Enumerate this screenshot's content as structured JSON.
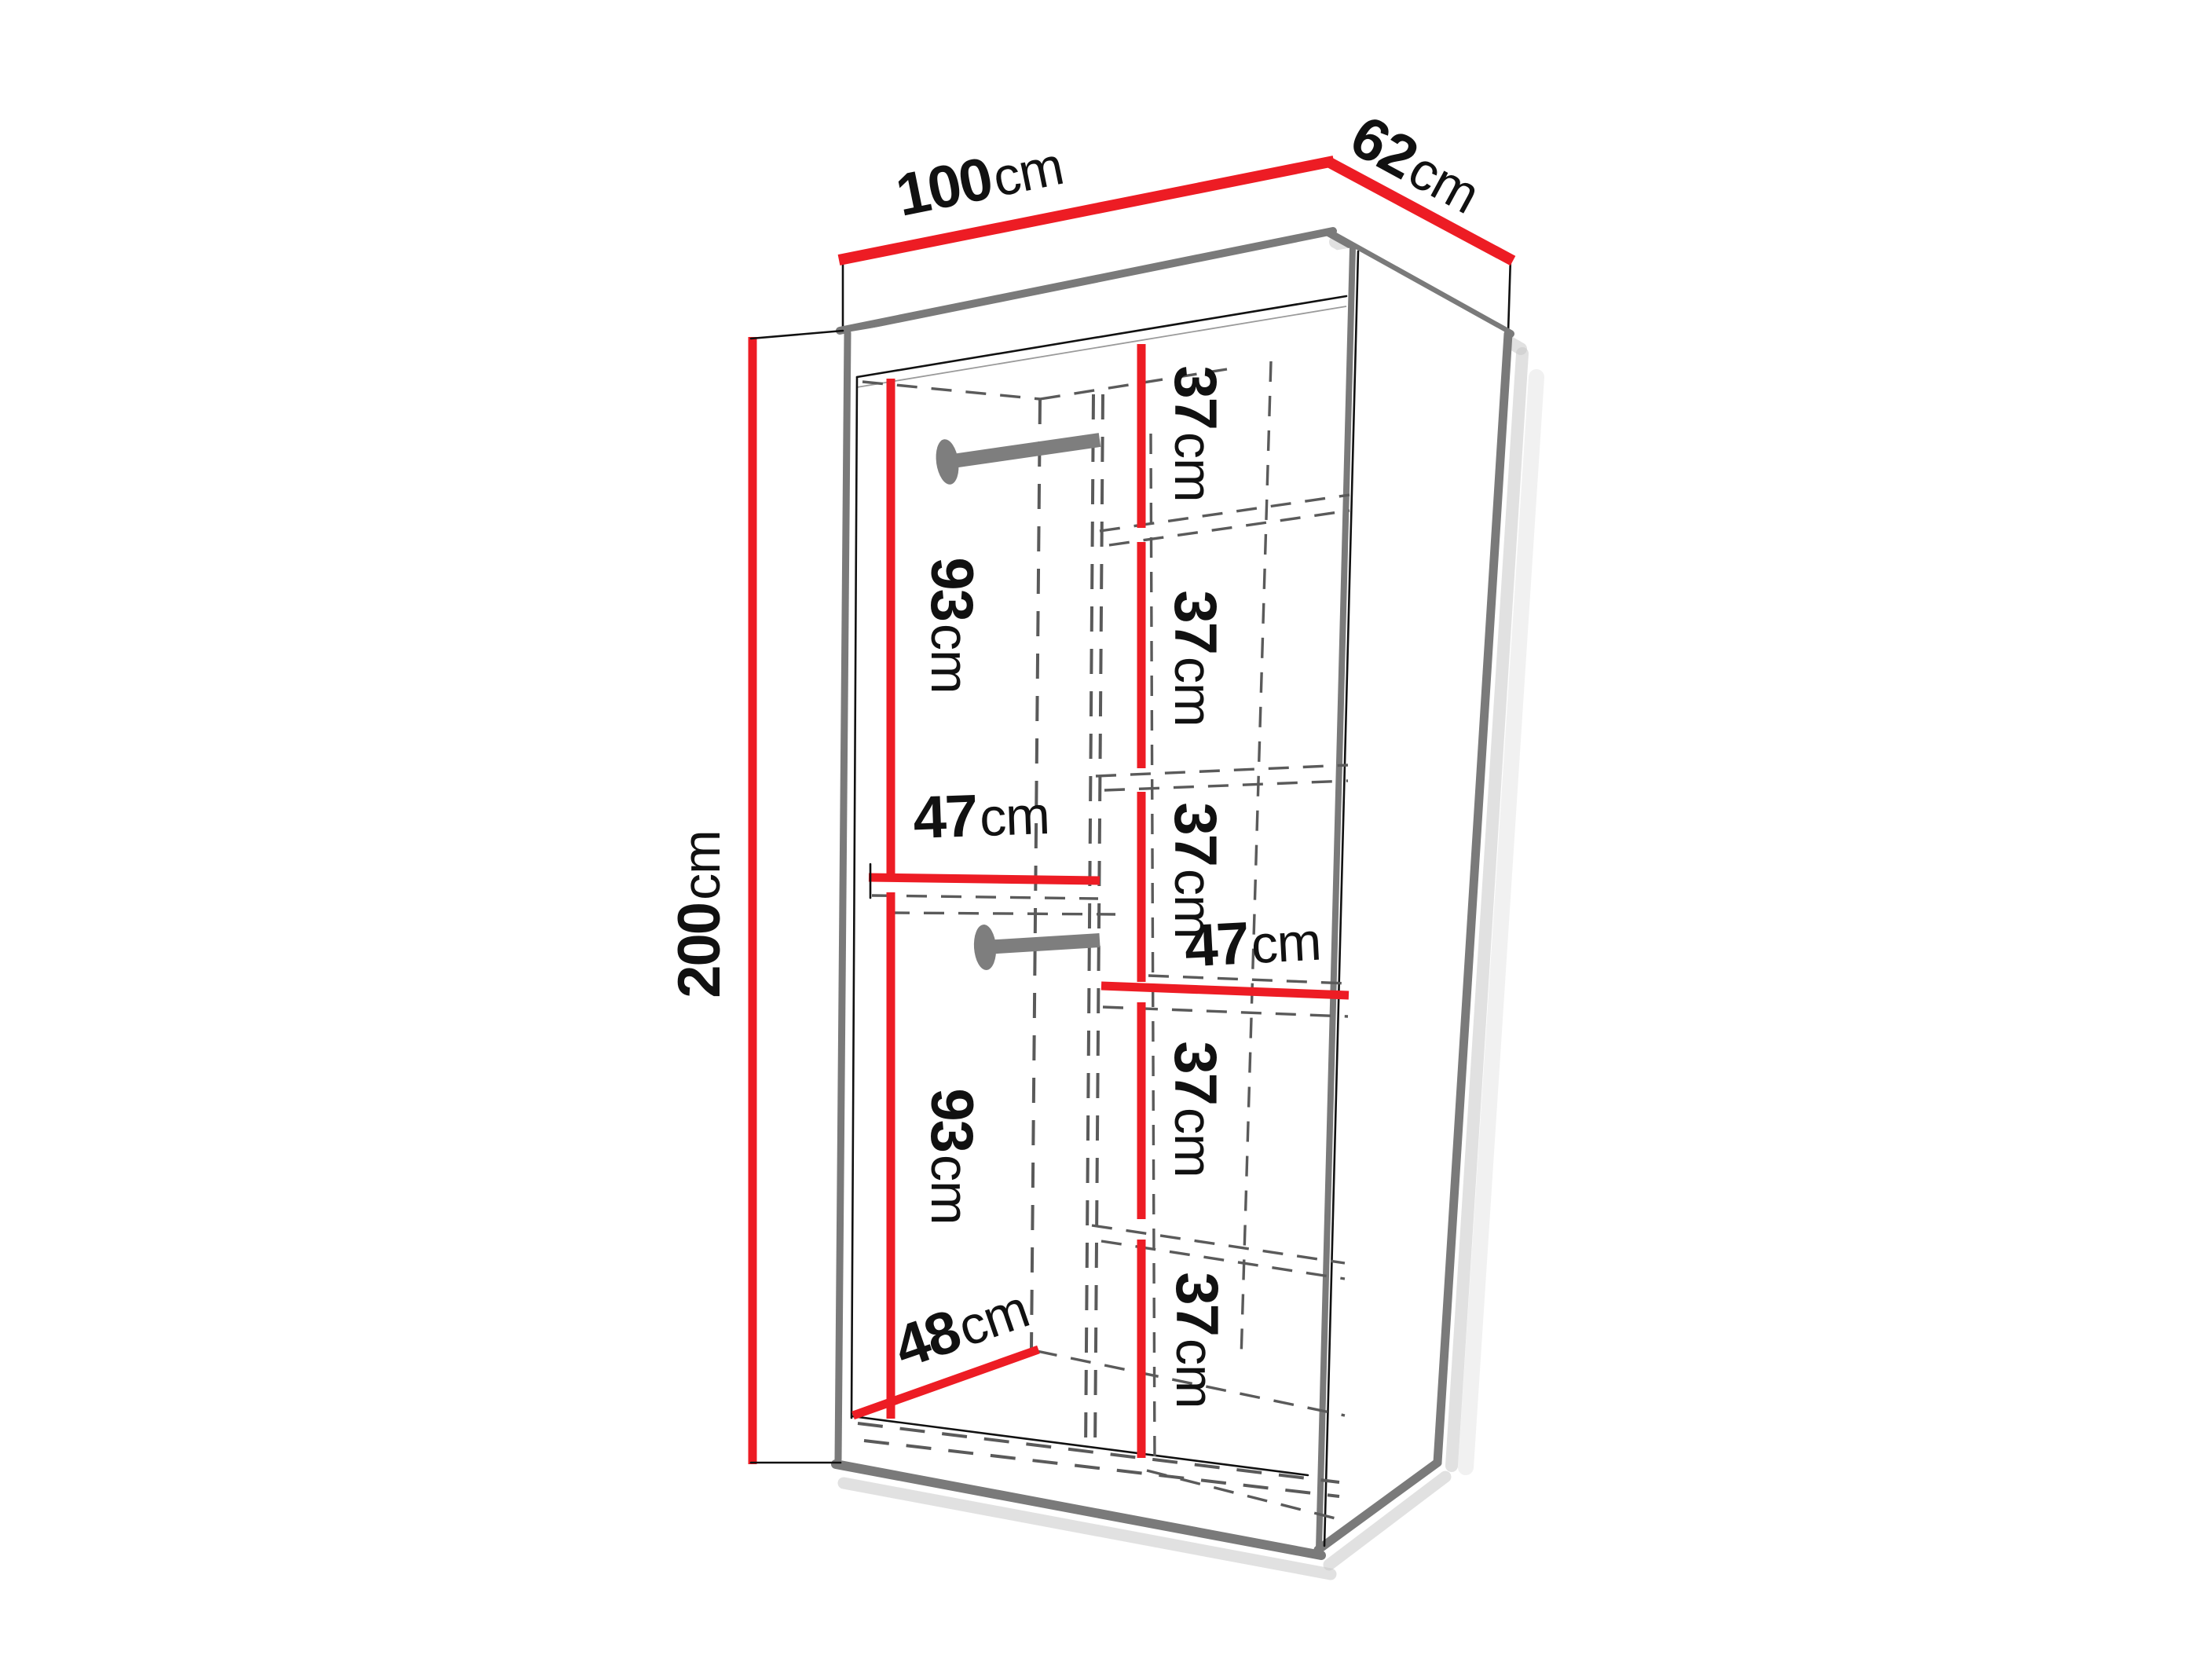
{
  "diagram": {
    "kind": "furniture dimension drawing",
    "subject": "wardrobe with two hanging rods and five shelf compartments",
    "units": "cm"
  },
  "colors": {
    "dimension_red": "#ed1c24",
    "edge_gray": "#7a7a7a",
    "ink_black": "#111111",
    "dashed_gray": "#5a5a5a",
    "rod_gray": "#7e7e7e",
    "shadow_gray": "#c9c9c9",
    "background": "#ffffff"
  },
  "labels": {
    "width": {
      "value": "100",
      "unit": "cm"
    },
    "depth": {
      "value": "62",
      "unit": "cm"
    },
    "height": {
      "value": "200",
      "unit": "cm"
    },
    "upper_hanging_height": {
      "value": "93",
      "unit": "cm"
    },
    "lower_hanging_height": {
      "value": "93",
      "unit": "cm"
    },
    "left_section_width": {
      "value": "47",
      "unit": "cm"
    },
    "right_section_width": {
      "value": "47",
      "unit": "cm"
    },
    "floor_depth": {
      "value": "48",
      "unit": "cm"
    },
    "shelf_gaps": [
      {
        "value": "37",
        "unit": "cm"
      },
      {
        "value": "37",
        "unit": "cm"
      },
      {
        "value": "37",
        "unit": "cm"
      },
      {
        "value": "37",
        "unit": "cm"
      },
      {
        "value": "37",
        "unit": "cm"
      }
    ]
  }
}
